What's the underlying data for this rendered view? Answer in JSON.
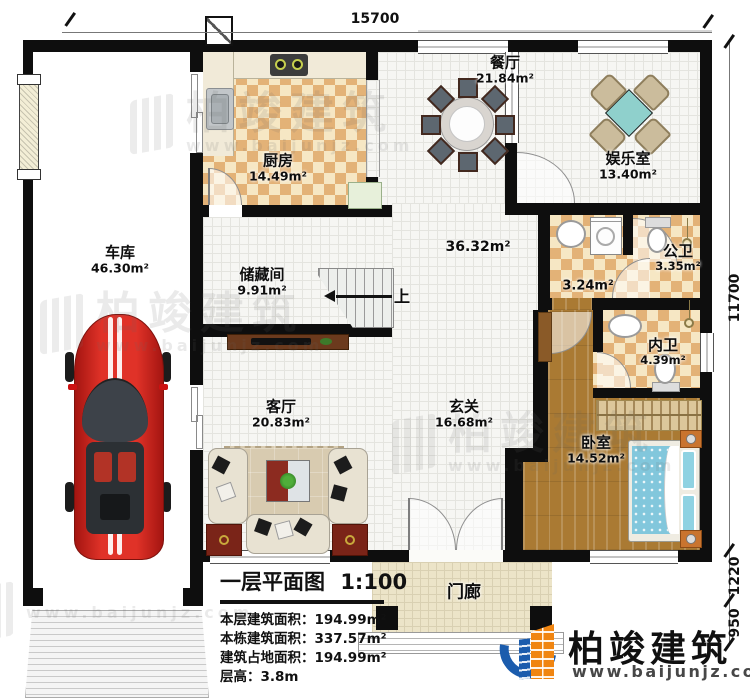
{
  "plan": {
    "dim_top": "15700",
    "dim_right_main": "11700",
    "dim_right_mid": "1220",
    "dim_right_low": "950",
    "stairs_up": "上"
  },
  "rooms": [
    {
      "id": "garage",
      "name": "车库",
      "area": "46.30m²"
    },
    {
      "id": "kitchen",
      "name": "厨房",
      "area": "14.49m²"
    },
    {
      "id": "dining",
      "name": "餐厅",
      "area": "21.84m²"
    },
    {
      "id": "entertainment",
      "name": "娱乐室",
      "area": "13.40m²"
    },
    {
      "id": "hall",
      "name": "",
      "area": "36.32m²"
    },
    {
      "id": "storage",
      "name": "储藏间",
      "area": "9.91m²"
    },
    {
      "id": "corridor",
      "name": "",
      "area": "3.24m²"
    },
    {
      "id": "public-bath",
      "name": "公卫",
      "area": "3.35m²"
    },
    {
      "id": "private-bath",
      "name": "内卫",
      "area": "4.39m²"
    },
    {
      "id": "living",
      "name": "客厅",
      "area": "20.83m²"
    },
    {
      "id": "foyer",
      "name": "玄关",
      "area": "16.68m²"
    },
    {
      "id": "bedroom",
      "name": "卧室",
      "area": "14.52m²"
    },
    {
      "id": "porch",
      "name": "门廊",
      "area": ""
    }
  ],
  "title_block": {
    "title": "一层平面图",
    "scale": "1:100",
    "lines": [
      "本层建筑面积：194.99m²",
      "本栋建筑面积：337.57m²",
      "建筑占地面积：194.99m²",
      "层高：3.8m"
    ]
  },
  "logo": {
    "name": "柏竣建筑",
    "url": "www.baijunjz.com"
  },
  "watermark": {
    "name": "柏竣建筑",
    "url": "www.baijunjz.com"
  }
}
